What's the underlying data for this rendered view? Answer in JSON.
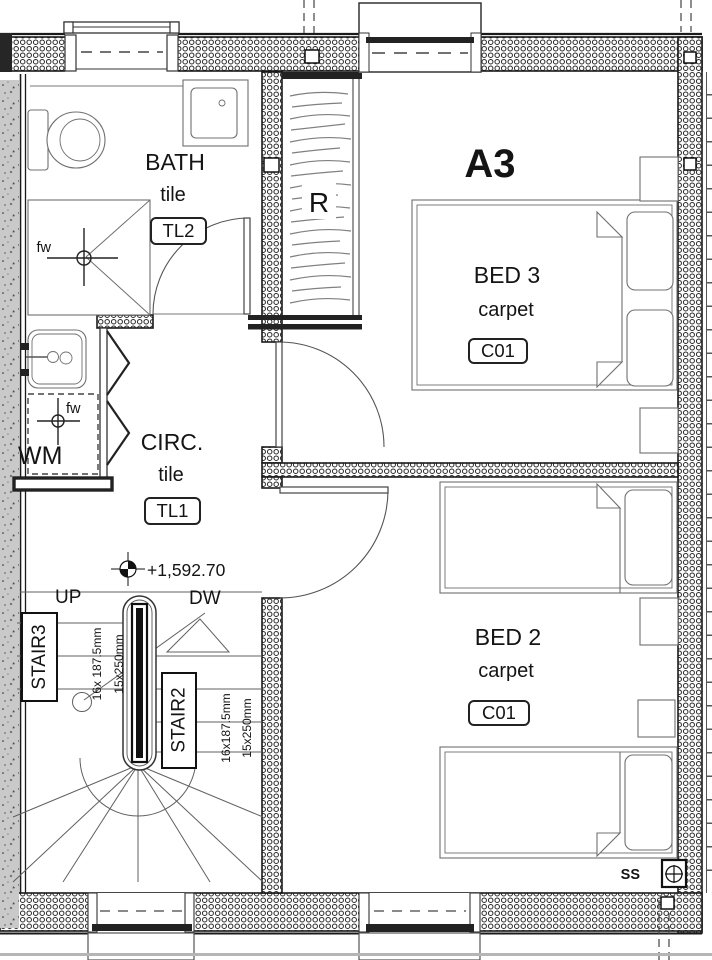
{
  "drawing": {
    "unit_label": "A3",
    "level_marker": "+1,592.70",
    "stack_label": "SS",
    "rooms": {
      "bath": {
        "name": "BATH",
        "finish": "tile",
        "code": "TL2",
        "floor_waste": "fw"
      },
      "circulation": {
        "name": "CIRC.",
        "finish": "tile",
        "code": "TL1"
      },
      "bed3": {
        "name": "BED 3",
        "finish": "carpet",
        "code": "C01"
      },
      "bed2": {
        "name": "BED 2",
        "finish": "carpet",
        "code": "C01"
      },
      "robe": {
        "name": "R"
      }
    },
    "laundry": {
      "appliance": "WM",
      "floor_waste": "fw"
    },
    "stairs": {
      "stair3": {
        "label": "STAIR3",
        "going": "16x 187.5mm",
        "tread": "15x250mm"
      },
      "stair2": {
        "label": "STAIR2",
        "going": "16x187.5mm",
        "tread": "15x250mm"
      },
      "up_label": "UP",
      "down_label": "DW"
    }
  }
}
